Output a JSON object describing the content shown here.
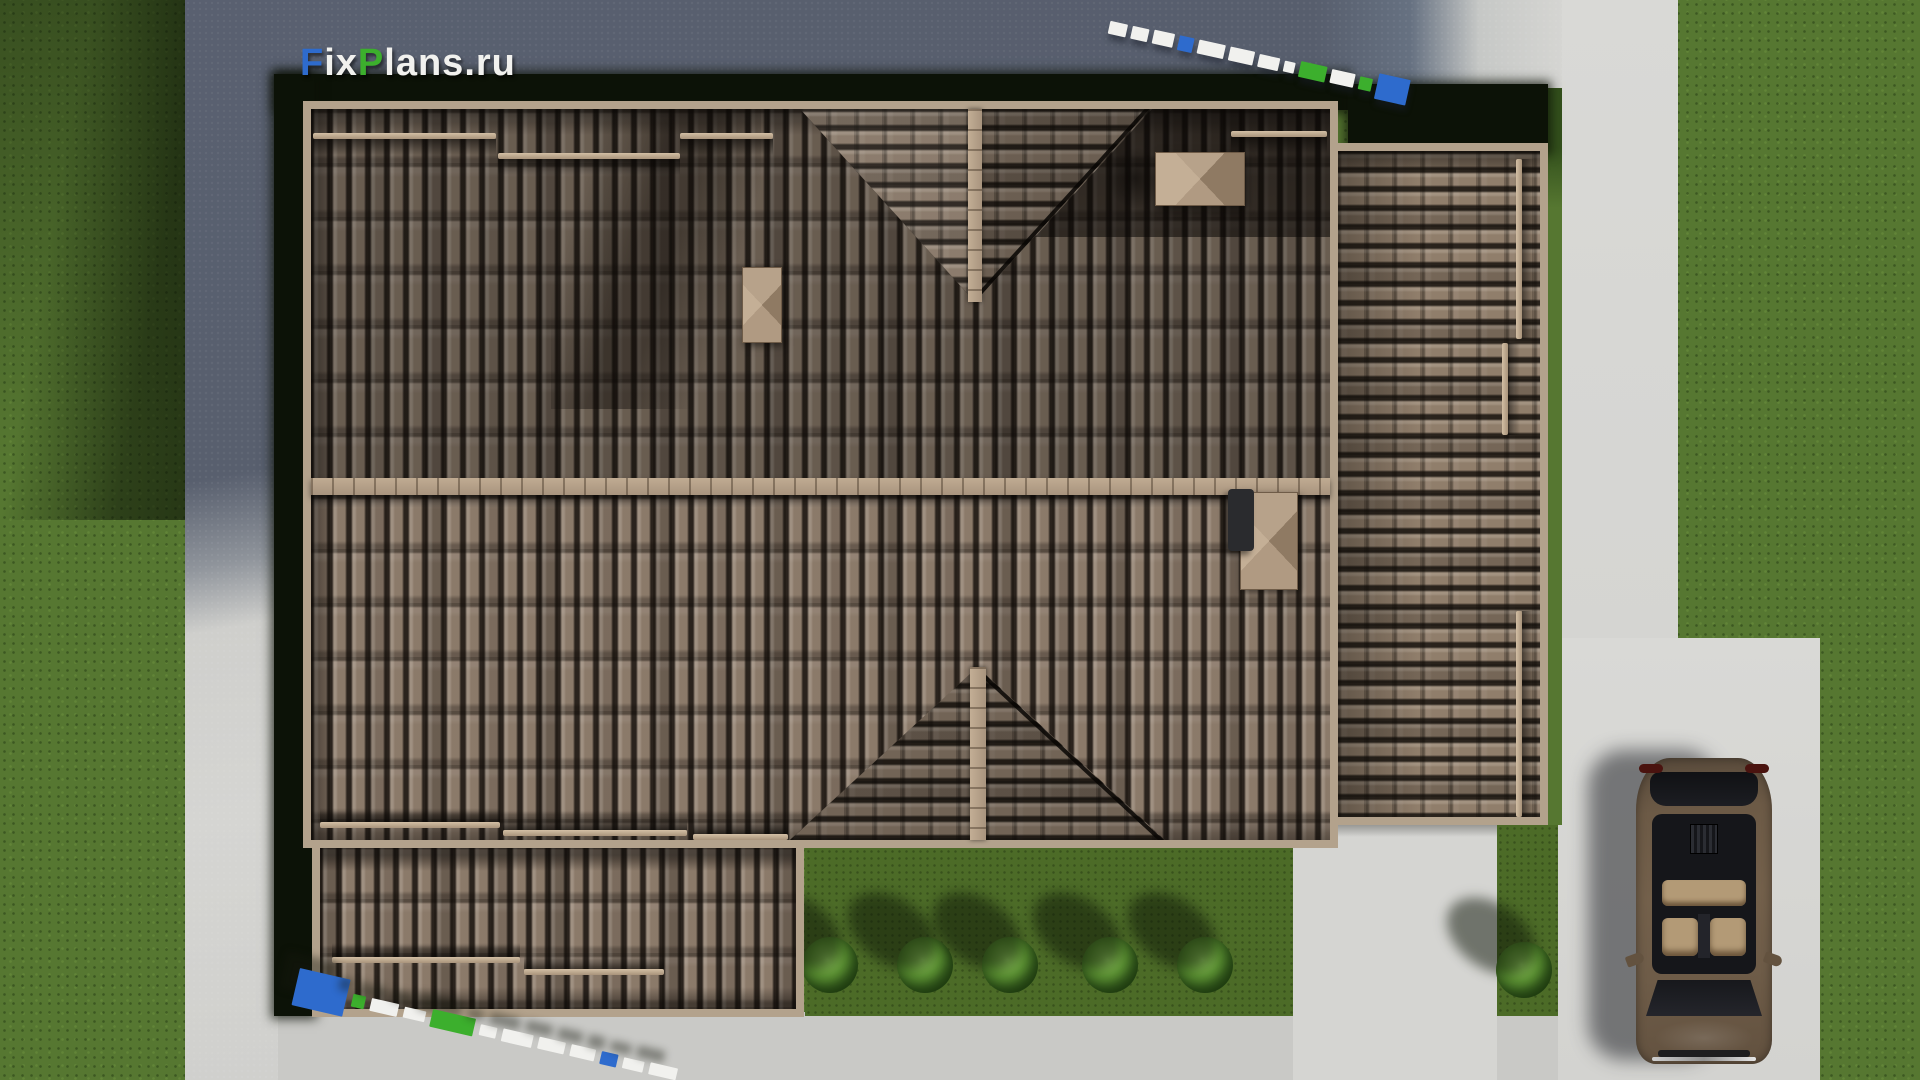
{
  "watermark": {
    "full": "FixPlans.ru",
    "f": "F",
    "ix": "ix",
    "p": "P",
    "lans": "lans",
    "dot_ru": ".ru"
  },
  "colors": {
    "grass": "#567731",
    "garden": "#4c6b27",
    "plaza_shadow": "#596070",
    "concrete_lit": "#d5d5d2",
    "concrete_apron": "#c9c9c6",
    "shadow_band": "#0c1207",
    "fascia": "#b3a28c",
    "ridge": "#a8947e",
    "snow_rail": "#d3bfa4",
    "tile_upper": "#7d6f61",
    "tile_lower": "#8d7c6c",
    "tile_garage": "#92806d",
    "tile_gable": "#877767",
    "logo_blue": "#2e6bcd",
    "logo_green": "#3caf2d",
    "logo_white": "#f1f1ee",
    "car_body": "#6c5a46",
    "car_glass": "#15161a",
    "seat": "#b39a76",
    "bush": "#5d9334"
  },
  "scene": {
    "view": "top-down aerial 3D render of a house roof plan",
    "roof_material": "brown barrel tiles",
    "chimney_count": 3,
    "gable_dormer_count": 2,
    "shrub_count": 6,
    "car_count": 1,
    "car_color_name": "bronze sedan"
  }
}
